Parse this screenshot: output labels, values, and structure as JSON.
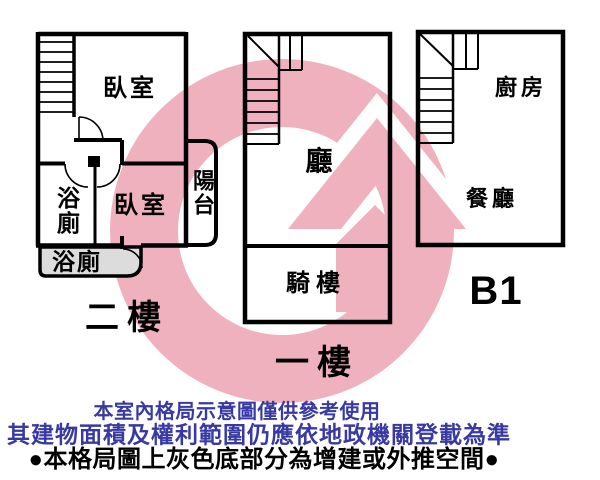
{
  "floor2": {
    "name": "二樓",
    "bedroom_top": "臥室",
    "bathroom": "浴廁",
    "bedroom_lower": "臥室",
    "balcony": "陽台",
    "bathroom_annex": "浴廁"
  },
  "floor1": {
    "name": "一樓",
    "hall": "廳",
    "arcade": "騎樓"
  },
  "basement": {
    "name": "B1",
    "kitchen": "廚房",
    "dining": "餐廳"
  },
  "disclaimer": {
    "line1": "本室內格局示意圖僅供參考使用",
    "line2": "其建物面積及權利範圍仍應依地政機關登載為準",
    "line3": "●本格局圖上灰色底部分為增建或外推空間●"
  },
  "colors": {
    "watermark_pink": "#F0B1BF",
    "annex_gray": "#DCDCDC",
    "wall_black": "#000000",
    "disclaimer_blue": "#3939A3"
  }
}
